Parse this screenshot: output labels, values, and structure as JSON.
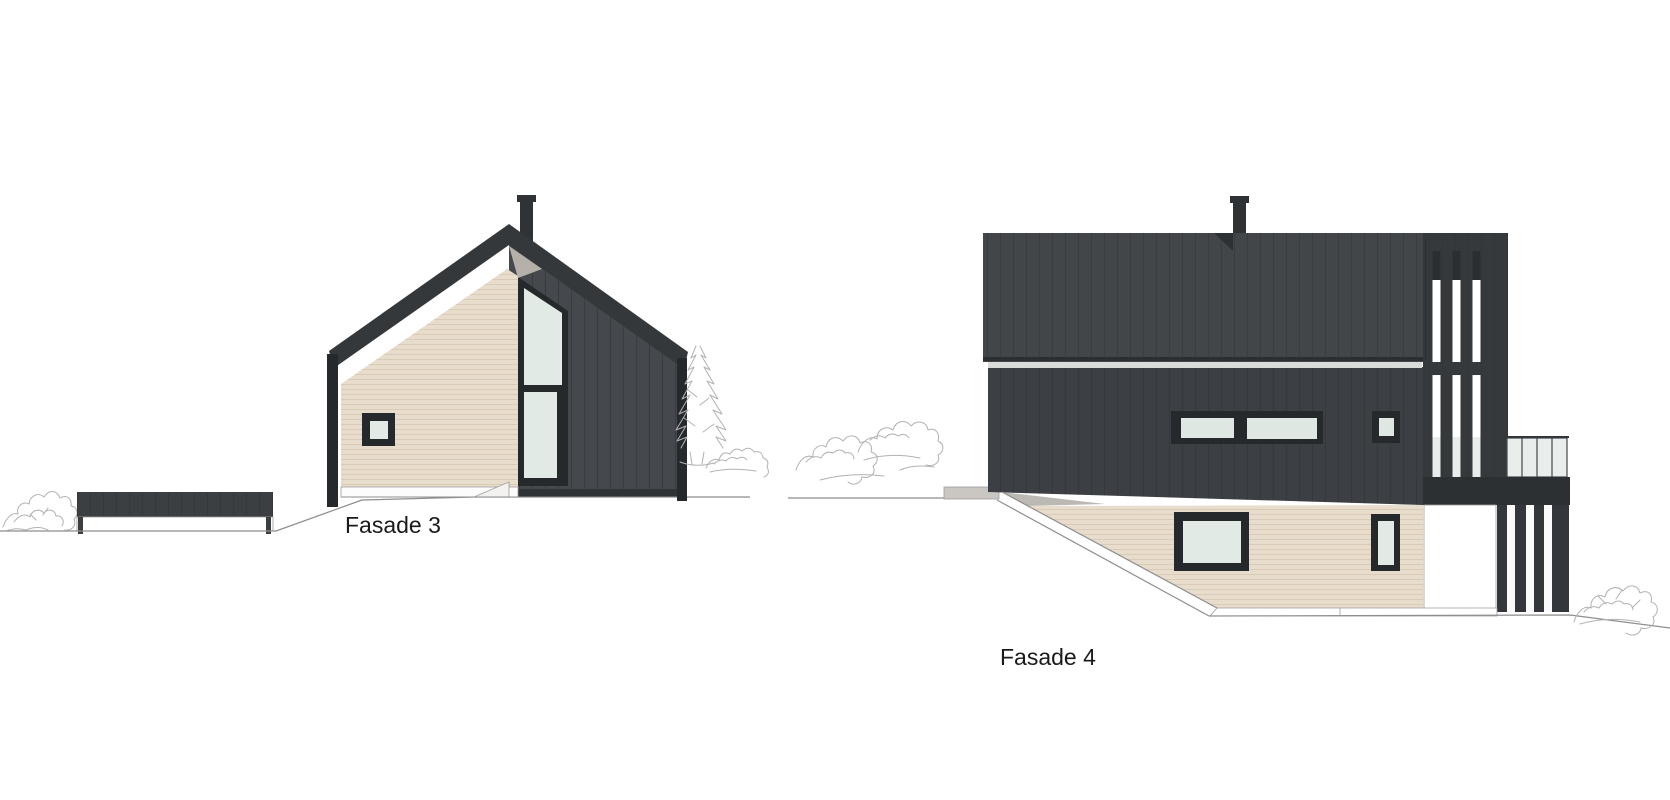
{
  "drawing": {
    "type": "architectural-elevation-sheet",
    "elevations": [
      {
        "id": "fasade3",
        "label": "Fasade 3"
      },
      {
        "id": "fasade4",
        "label": "Fasade 4"
      }
    ],
    "palette": {
      "background": "#ffffff",
      "dark_roof": "#35383b",
      "dark_cladding": "#3e4145",
      "dark_cladding_light": "#45484c",
      "timber_cladding": "#e8ddcc",
      "timber_line": "#d9cbb6",
      "window_frame": "#26292b",
      "window_glass": "#e2eae6",
      "railing_glass": "#e9edec",
      "concrete": "#c9c6c1",
      "soffit_grey": "#b5b1aa",
      "sketch_line": "#b2b2b2",
      "label_color": "#1a1a1a"
    }
  }
}
